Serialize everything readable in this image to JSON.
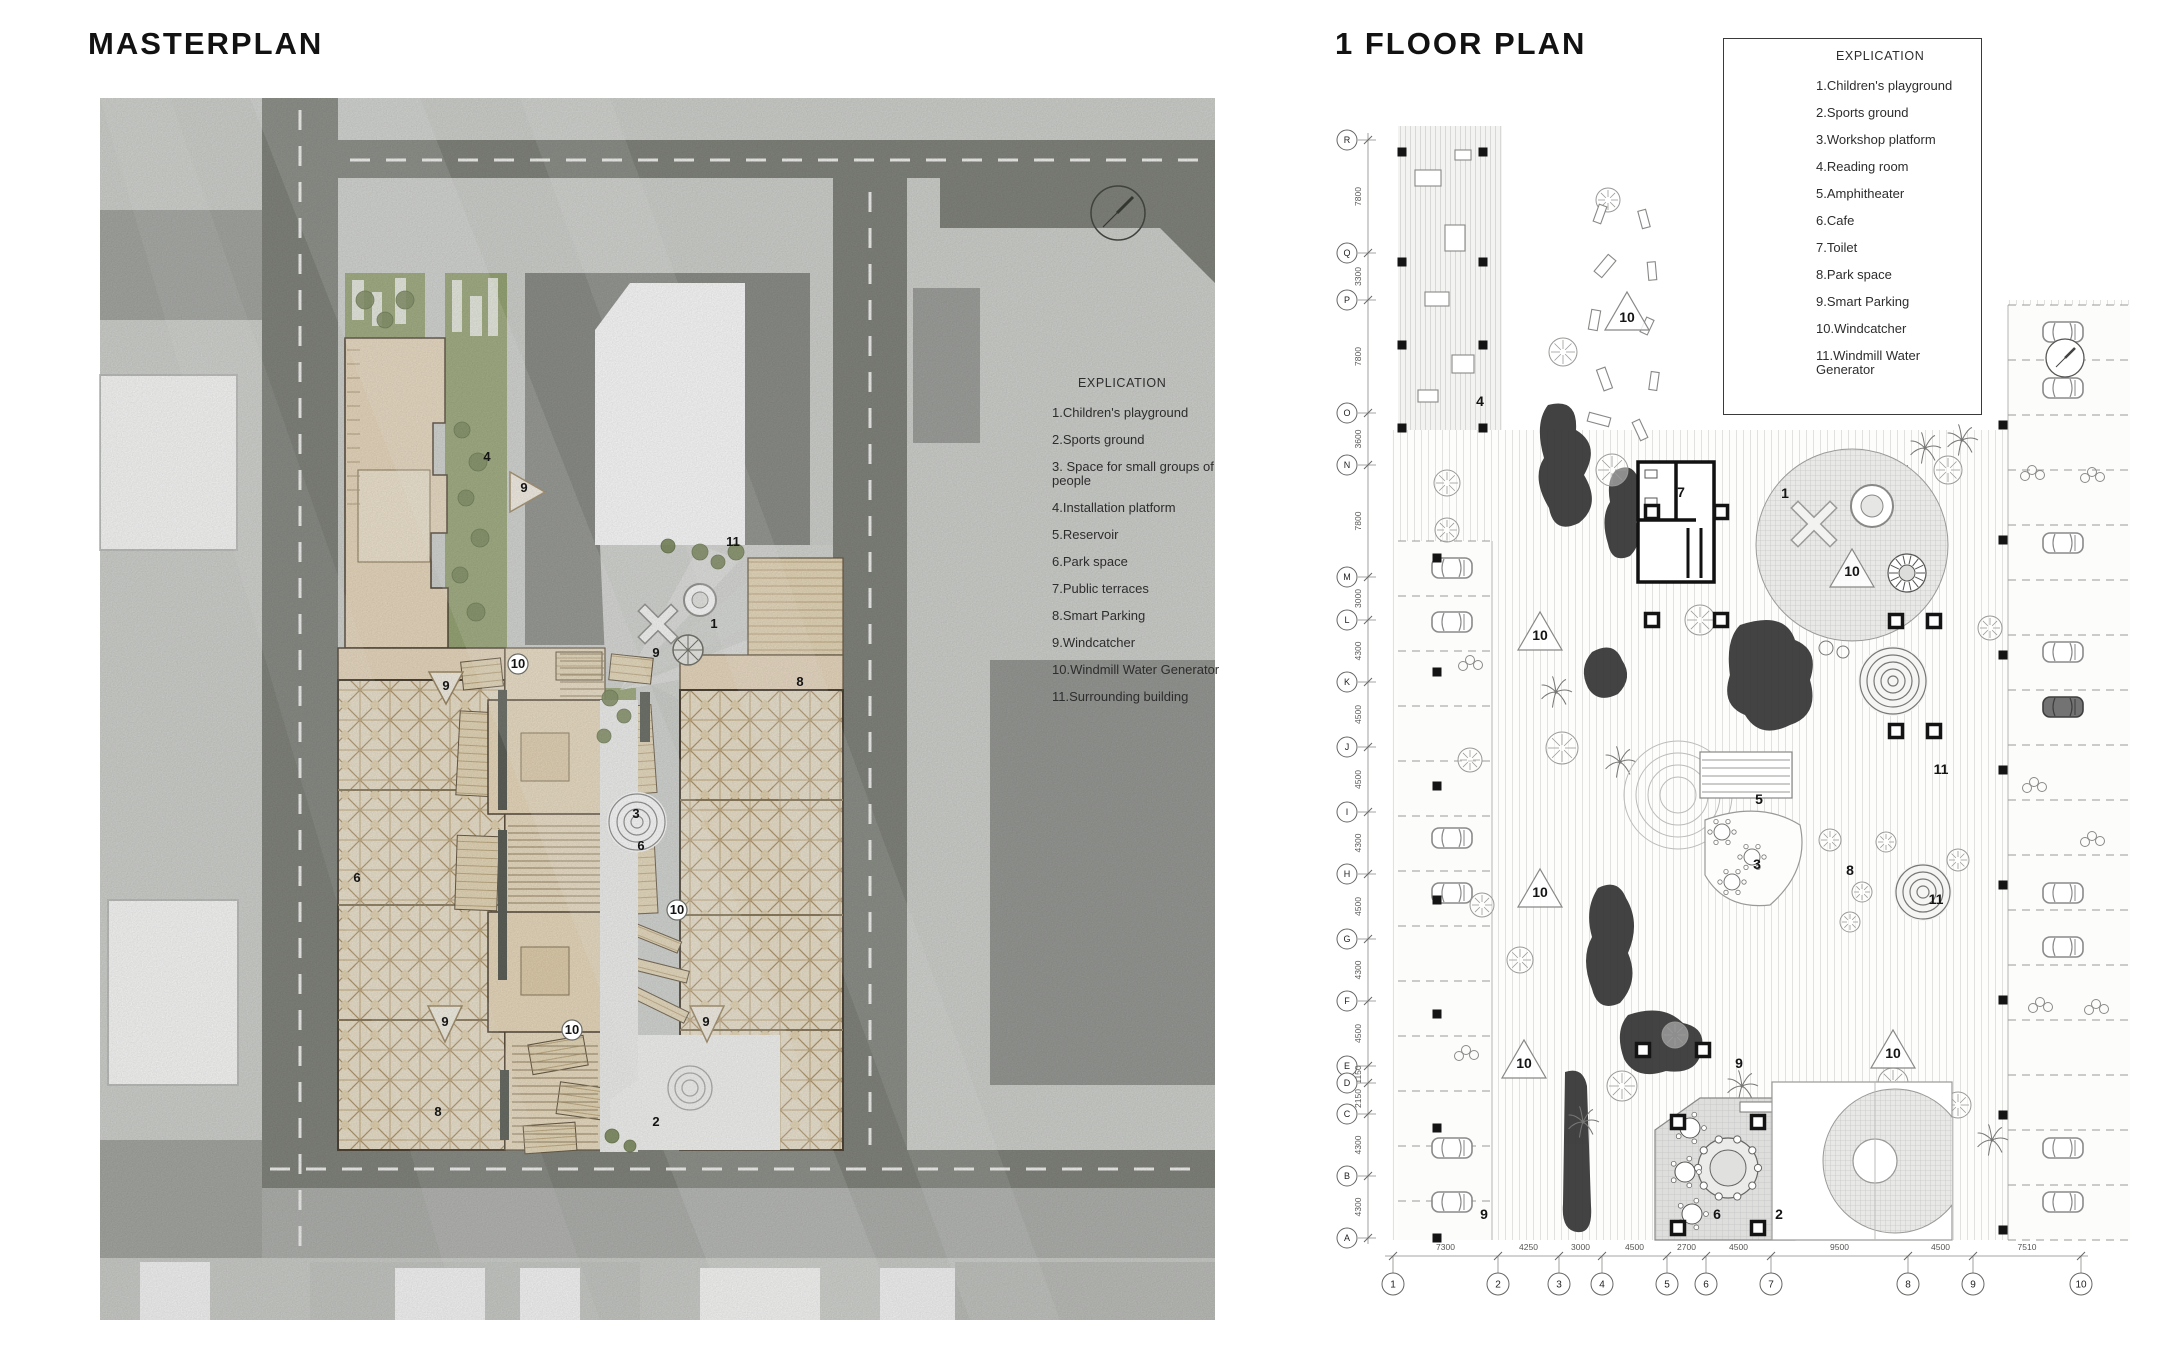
{
  "masterplan": {
    "title": "MASTERPLAN",
    "explication": {
      "heading": "EXPLICATION",
      "items": [
        "1.Children's playground",
        "2.Sports ground",
        "3. Space for small groups of people",
        "4.Installation platform",
        "5.Reservoir",
        "6.Park space",
        "7.Public terraces",
        "8.Smart Parking",
        "9.Windcatcher",
        "10.Windmill Water Generator",
        "11.Surrounding building"
      ]
    },
    "plan_labels": [
      {
        "n": "4",
        "x": 487,
        "y": 461
      },
      {
        "n": "9",
        "x": 524,
        "y": 492
      },
      {
        "n": "11",
        "x": 733,
        "y": 546
      },
      {
        "n": "1",
        "x": 714,
        "y": 628
      },
      {
        "n": "9",
        "x": 656,
        "y": 657
      },
      {
        "n": "10",
        "x": 518,
        "y": 668,
        "circled": true
      },
      {
        "n": "9",
        "x": 446,
        "y": 690
      },
      {
        "n": "8",
        "x": 800,
        "y": 686
      },
      {
        "n": "3",
        "x": 636,
        "y": 818
      },
      {
        "n": "6",
        "x": 641,
        "y": 850
      },
      {
        "n": "6",
        "x": 357,
        "y": 882
      },
      {
        "n": "10",
        "x": 677,
        "y": 914,
        "circled": true
      },
      {
        "n": "9",
        "x": 445,
        "y": 1026
      },
      {
        "n": "10",
        "x": 572,
        "y": 1034,
        "circled": true
      },
      {
        "n": "9",
        "x": 706,
        "y": 1026
      },
      {
        "n": "8",
        "x": 438,
        "y": 1116
      },
      {
        "n": "2",
        "x": 656,
        "y": 1126
      }
    ]
  },
  "floorplan": {
    "title": "1 FLOOR PLAN",
    "explication": {
      "heading": "EXPLICATION",
      "items": [
        "1.Children's playground",
        "2.Sports ground",
        "3.Workshop platform",
        "4.Reading room",
        "5.Amphitheater",
        "6.Cafe",
        "7.Toilet",
        "8.Park space",
        "9.Smart Parking",
        "10.Windcatcher",
        "11.Windmill Water Generator"
      ]
    },
    "plan_labels": [
      {
        "n": "4",
        "x": 1480,
        "y": 406
      },
      {
        "n": "10",
        "x": 1627,
        "y": 322
      },
      {
        "n": "7",
        "x": 1681,
        "y": 497
      },
      {
        "n": "1",
        "x": 1785,
        "y": 498
      },
      {
        "n": "10",
        "x": 1852,
        "y": 576
      },
      {
        "n": "10",
        "x": 1540,
        "y": 640
      },
      {
        "n": "5",
        "x": 1759,
        "y": 804
      },
      {
        "n": "11",
        "x": 1941,
        "y": 774
      },
      {
        "n": "3",
        "x": 1757,
        "y": 869
      },
      {
        "n": "8",
        "x": 1850,
        "y": 875
      },
      {
        "n": "11",
        "x": 1936,
        "y": 904
      },
      {
        "n": "10",
        "x": 1540,
        "y": 897
      },
      {
        "n": "9",
        "x": 1739,
        "y": 1068
      },
      {
        "n": "10",
        "x": 1524,
        "y": 1068
      },
      {
        "n": "10",
        "x": 1893,
        "y": 1058
      },
      {
        "n": "9",
        "x": 1484,
        "y": 1219
      },
      {
        "n": "6",
        "x": 1717,
        "y": 1219
      },
      {
        "n": "2",
        "x": 1779,
        "y": 1219
      }
    ],
    "axes": {
      "bottom": {
        "bubbles": [
          "1",
          "2",
          "3",
          "4",
          "5",
          "6",
          "7",
          "8",
          "9",
          "10"
        ],
        "x": [
          1393,
          1498,
          1559,
          1602,
          1667,
          1706,
          1771,
          1908,
          1973,
          2081
        ],
        "y": 1284,
        "dims": [
          "7300",
          "4250",
          "3000",
          "4500",
          "2700",
          "4500",
          "9500",
          "4500",
          "7510"
        ]
      },
      "left": {
        "bubbles": [
          "R",
          "Q",
          "P",
          "O",
          "N",
          "M",
          "L",
          "K",
          "J",
          "I",
          "H",
          "G",
          "F",
          "E",
          "D",
          "C",
          "B",
          "A"
        ],
        "y": [
          140,
          253,
          300,
          413,
          465,
          577,
          620,
          682,
          747,
          812,
          874,
          939,
          1001,
          1066,
          1083,
          1114,
          1176,
          1238
        ],
        "x": 1347,
        "dims": [
          "7800",
          "3300",
          "7800",
          "3600",
          "7800",
          "3000",
          "4300",
          "4500",
          "4500",
          "4300",
          "4500",
          "4300",
          "4500",
          "1150",
          "2150",
          "4300",
          "4300"
        ]
      }
    }
  }
}
